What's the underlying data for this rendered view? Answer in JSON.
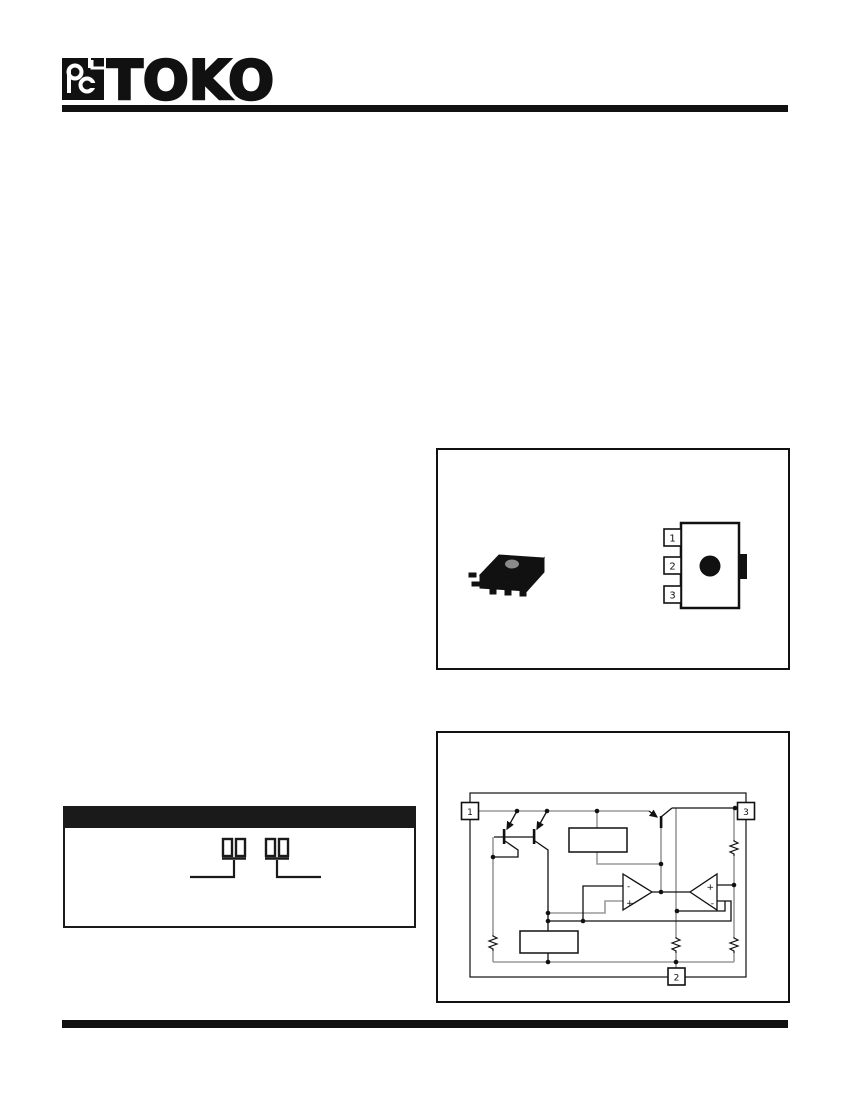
{
  "brand": {
    "name": "TOKO"
  },
  "figures": {
    "package": {
      "pin_labels": [
        "1",
        "2",
        "3"
      ]
    },
    "block_diagram": {
      "pin1": "1",
      "pin2": "2",
      "pin3": "3",
      "opamp_left": {
        "inverting": "-",
        "noninverting": "+"
      },
      "opamp_right": {
        "noninverting": "+",
        "inverting": "-"
      }
    }
  },
  "colors": {
    "ink": "#111111",
    "wire_gray": "#9a9a9a",
    "indicator_dot": "#8a8a8a"
  }
}
